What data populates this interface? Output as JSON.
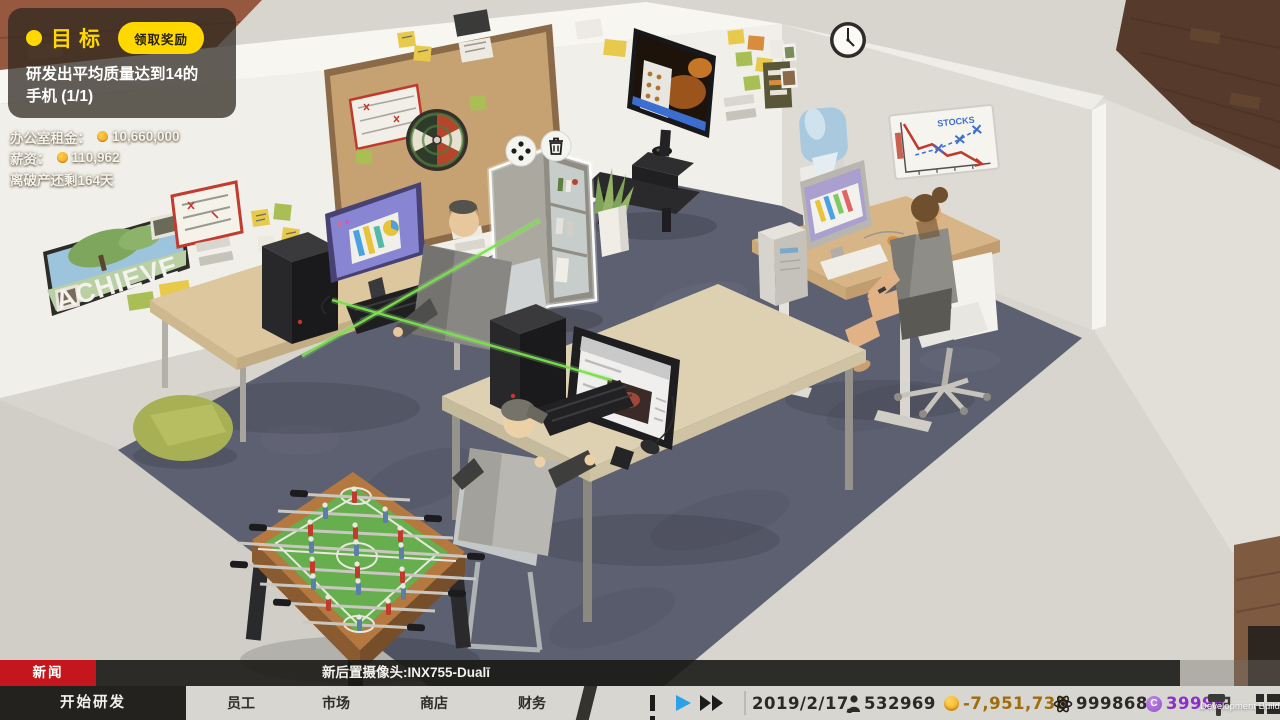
{
  "goal": {
    "title": "目标",
    "claim_button": "领取奖励",
    "description": "研发出平均质量达到14的手机 (1/1)"
  },
  "finance": {
    "rent_label": "办公室租金：",
    "rent_value": "10,660,000",
    "salary_label": "薪资：",
    "salary_value": "110,962",
    "bankruptcy": "离破产还剩164天"
  },
  "news": {
    "label": "新闻",
    "ticker": "新后置摄像头:INX755-Dualī"
  },
  "toolbar": {
    "tabs": [
      {
        "label": "开始研发",
        "active": true
      },
      {
        "label": "员工",
        "active": false
      },
      {
        "label": "市场",
        "active": false
      },
      {
        "label": "商店",
        "active": false
      },
      {
        "label": "财务",
        "active": false
      }
    ],
    "date": "2019/2/17",
    "stats": {
      "population": "532969",
      "money": "-7,951,738",
      "research": "999868",
      "premium": "39996"
    }
  },
  "watermark": "Development Build",
  "scene": {
    "achieve_text": "ACHIEVE",
    "stocks_text": "STOCKS"
  },
  "colors": {
    "accent_yellow": "#ffd800",
    "news_red": "#c5161d",
    "play_blue": "#2ba2e8",
    "coin_gold": "#efa414",
    "premium_purple": "#8b2fc9",
    "money_negative": "#a06c10",
    "carpet": "#5d6070",
    "toolbar_bg": "#d8d6d1"
  }
}
